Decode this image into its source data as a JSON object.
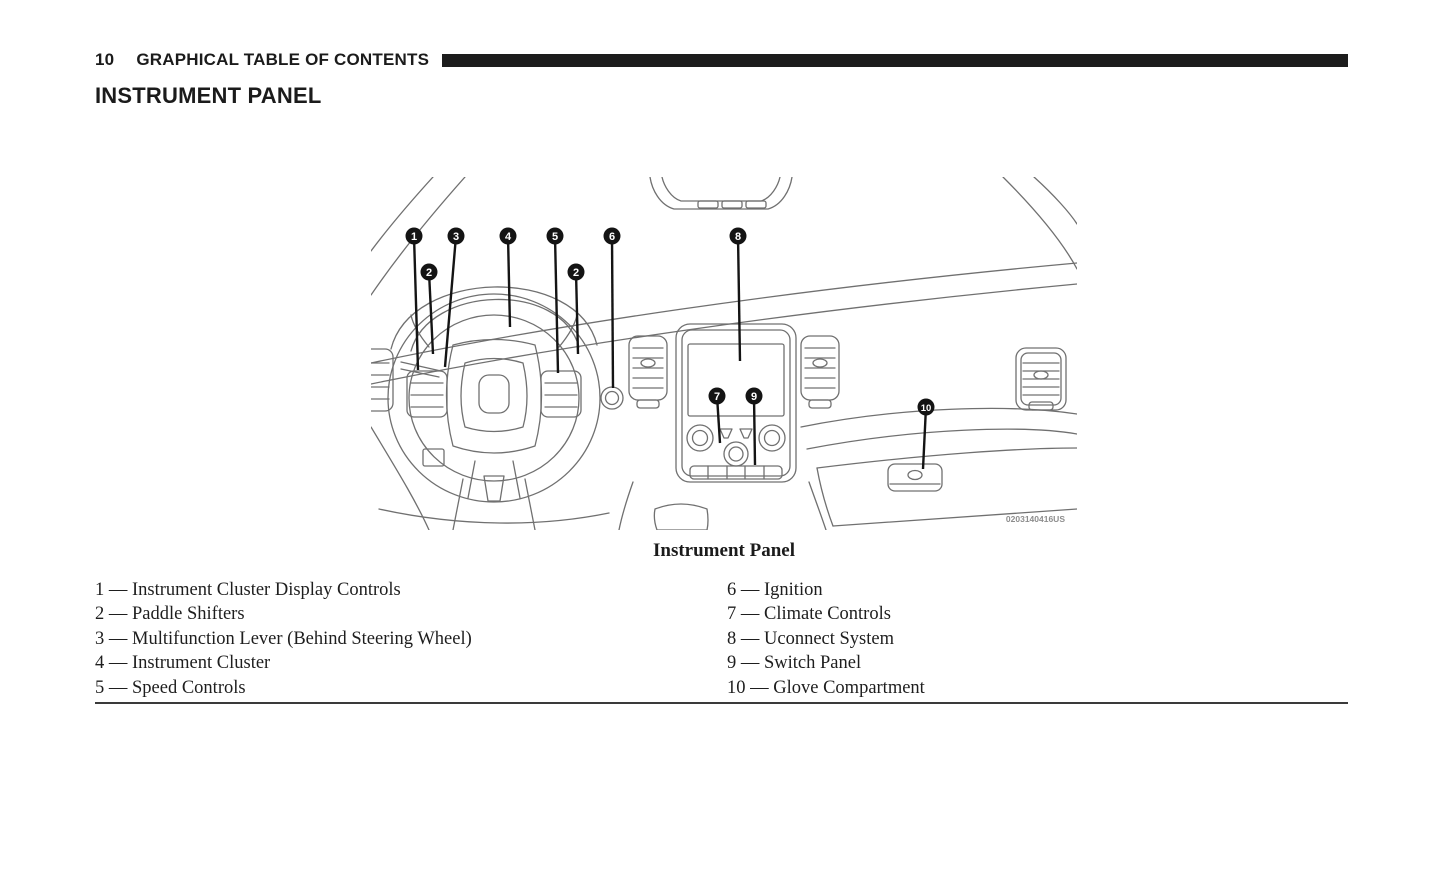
{
  "page": {
    "number": "10",
    "header_title": "GRAPHICAL TABLE OF CONTENTS",
    "section_title": "INSTRUMENT PANEL"
  },
  "figure": {
    "caption": "Instrument Panel",
    "image_code": "0203140416US",
    "callouts": [
      {
        "label": "1",
        "name": "instrument-cluster-display-controls",
        "cx": 43,
        "cy": 59,
        "tx": 47,
        "ty": 193
      },
      {
        "label": "2",
        "name": "paddle-shifter-left",
        "cx": 58,
        "cy": 95,
        "tx": 62,
        "ty": 177
      },
      {
        "label": "3",
        "name": "multifunction-lever",
        "cx": 85,
        "cy": 59,
        "tx": 74,
        "ty": 190
      },
      {
        "label": "4",
        "name": "instrument-cluster",
        "cx": 137,
        "cy": 59,
        "tx": 139,
        "ty": 150
      },
      {
        "label": "5",
        "name": "speed-controls",
        "cx": 184,
        "cy": 59,
        "tx": 187,
        "ty": 196
      },
      {
        "label": "2",
        "name": "paddle-shifter-right",
        "cx": 205,
        "cy": 95,
        "tx": 207,
        "ty": 177
      },
      {
        "label": "6",
        "name": "ignition",
        "cx": 241,
        "cy": 59,
        "tx": 242,
        "ty": 211
      },
      {
        "label": "8",
        "name": "uconnect-system",
        "cx": 367,
        "cy": 59,
        "tx": 369,
        "ty": 184
      },
      {
        "label": "7",
        "name": "climate-controls",
        "cx": 346,
        "cy": 219,
        "tx": 349,
        "ty": 266
      },
      {
        "label": "9",
        "name": "switch-panel",
        "cx": 383,
        "cy": 219,
        "tx": 384,
        "ty": 288
      },
      {
        "label": "10",
        "name": "glove-compartment",
        "cx": 555,
        "cy": 230,
        "tx": 552,
        "ty": 292
      }
    ]
  },
  "legend": {
    "separator": "—",
    "left": [
      {
        "num": "1",
        "label": "Instrument Cluster Display Controls"
      },
      {
        "num": "2",
        "label": "Paddle Shifters"
      },
      {
        "num": "3",
        "label": "Multifunction Lever (Behind Steering Wheel)"
      },
      {
        "num": "4",
        "label": "Instrument Cluster"
      },
      {
        "num": "5",
        "label": "Speed Controls"
      }
    ],
    "right": [
      {
        "num": "6",
        "label": "Ignition"
      },
      {
        "num": "7",
        "label": "Climate Controls"
      },
      {
        "num": "8",
        "label": "Uconnect System"
      },
      {
        "num": "9",
        "label": "Switch Panel"
      },
      {
        "num": "10",
        "label": "Glove Compartment"
      }
    ]
  }
}
